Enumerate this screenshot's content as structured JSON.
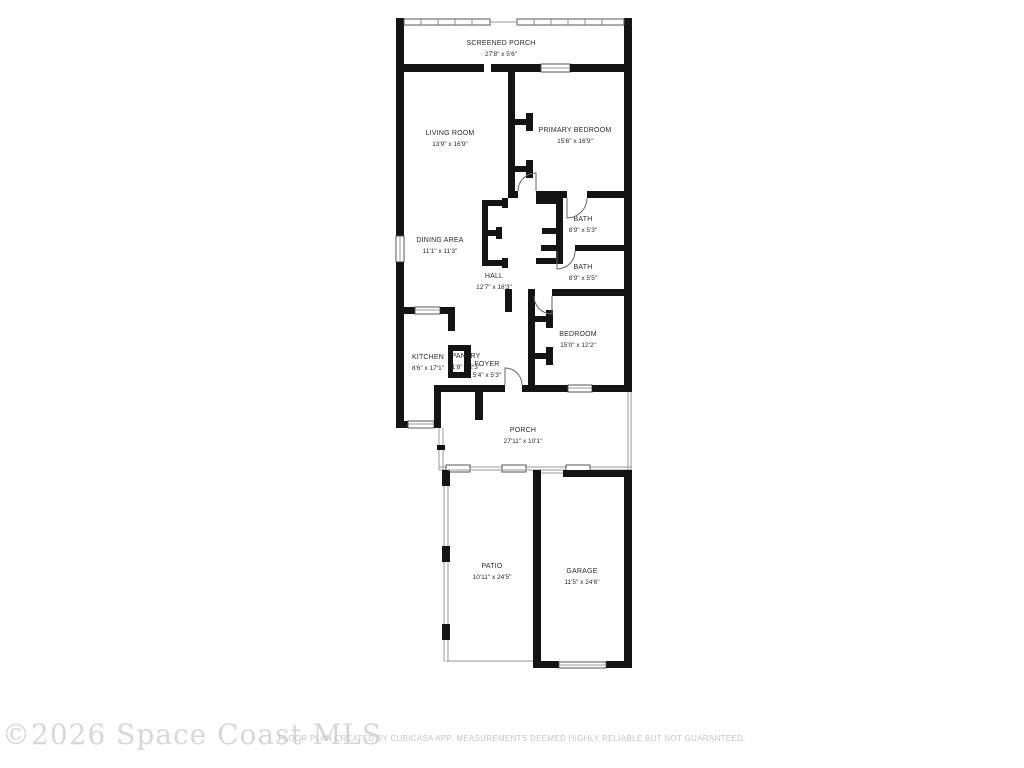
{
  "colors": {
    "background": "#ffffff",
    "wall": "#141414",
    "thin_line": "#9a9a9a",
    "label_text": "#2a2a2a",
    "watermark_text": "#d7d7d7",
    "footer_text": "#c5c5c5"
  },
  "rooms": {
    "screened_porch": {
      "name": "SCREENED PORCH",
      "dims": "27'8\" x 5'6\""
    },
    "living_room": {
      "name": "LIVING ROOM",
      "dims": "13'9\" x 16'9\""
    },
    "primary_bedroom": {
      "name": "PRIMARY BEDROOM",
      "dims": "15'6\" x 16'9\""
    },
    "bath_1": {
      "name": "BATH",
      "dims": "8'9\" x 5'3\""
    },
    "dining_area": {
      "name": "DINING AREA",
      "dims": "11'1\" x 11'3\""
    },
    "bath_2": {
      "name": "BATH",
      "dims": "8'9\" x 5'5\""
    },
    "hall": {
      "name": "HALL",
      "dims": "12'7\" x 18'3\""
    },
    "bedroom": {
      "name": "BEDROOM",
      "dims": "15'0\" x 12'2\""
    },
    "kitchen": {
      "name": "KITCHEN",
      "dims": "8'6\" x 17'1\""
    },
    "pantry": {
      "name": "PANTRY",
      "dims": "1'8\" x 2'3\""
    },
    "foyer": {
      "name": "FOYER",
      "dims": "5'4\" x 5'3\""
    },
    "porch": {
      "name": "PORCH",
      "dims": "27'11\" x 10'1\""
    },
    "patio": {
      "name": "PATIO",
      "dims": "10'11\" x 24'5\""
    },
    "garage": {
      "name": "GARAGE",
      "dims": "11'5\" x 24'6\""
    }
  },
  "watermark": {
    "text": "©2026 Space Coast MLS"
  },
  "footer": {
    "text": "FLOOR PLAN CREATED BY CUBICASA APP. MEASUREMENTS DEEMED HIGHLY RELIABLE BUT NOT GUARANTEED."
  }
}
